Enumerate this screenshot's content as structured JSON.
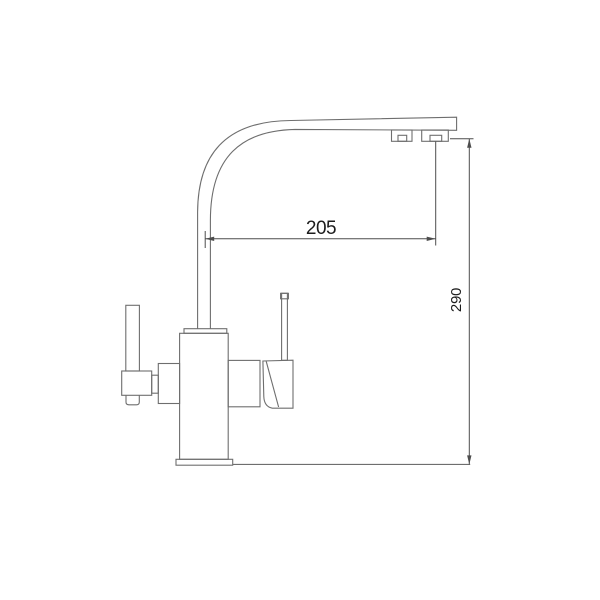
{
  "drawing": {
    "subject": "kitchen-faucet-side-view-technical-drawing",
    "style": "line-drawing",
    "background_color": "#ffffff",
    "line_color": "#6e6e6e",
    "dimension_color": "#4d4d4d",
    "text_color": "#1c1c1c",
    "dimensions": [
      {
        "id": "spout-reach",
        "value": "205",
        "orientation": "horizontal"
      },
      {
        "id": "spout-height",
        "value": "290",
        "orientation": "vertical"
      }
    ]
  }
}
